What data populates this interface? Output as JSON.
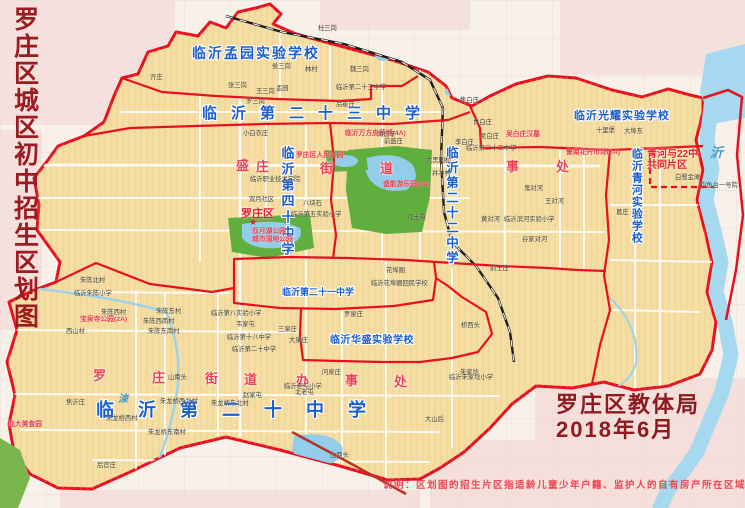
{
  "page": {
    "title_vertical": "罗庄区城区初中招生区划图"
  },
  "footer": {
    "agency": "罗庄区教体局",
    "date": "2018年6月",
    "disclaimer": "说明：区划图的招生片区指适龄儿童少年户籍、监护人的自有房产所在区域"
  },
  "colors": {
    "district_fill": "#f5dfa0",
    "boundary_red": "#e8101e",
    "school_blue": "#1a5ed0",
    "street_red": "#ee4253",
    "title_maroon": "#9c1b20",
    "river_blue": "#a6d9ef",
    "park_green": "#5fae3e"
  },
  "map": {
    "school_zone_labels": [
      {
        "t": "临沂孟园实验学校",
        "x": 192,
        "y": 46,
        "fs": 14,
        "ls": 2,
        "name": "label-mengyuan-school"
      },
      {
        "t": "临沂第二十三中学",
        "x": 202,
        "y": 106,
        "fs": 15,
        "ls": 14,
        "name": "label-no23-school"
      },
      {
        "t": "临沂第四十中学",
        "x": 279,
        "y": 146,
        "fs": 13,
        "ls": 3,
        "v": 1,
        "name": "label-no40-school"
      },
      {
        "t": "临沂第二十二中学",
        "x": 444,
        "y": 146,
        "fs": 12.5,
        "ls": 2.5,
        "v": 1,
        "name": "label-no22-school"
      },
      {
        "t": "临沂光耀实验学校",
        "x": 574,
        "y": 110,
        "fs": 11,
        "ls": 1,
        "name": "label-guangyao-school"
      },
      {
        "t": "临沂青河实验学校",
        "x": 630,
        "y": 148,
        "fs": 11,
        "ls": 1,
        "v": 1,
        "name": "label-qinghe-school"
      },
      {
        "t": "临沂第二十一中学",
        "x": 282,
        "y": 287,
        "fs": 9,
        "ls": 0,
        "name": "label-no21-school"
      },
      {
        "t": "临沂华盛实验学校",
        "x": 330,
        "y": 335,
        "fs": 10,
        "ls": 0.5,
        "name": "label-huasheng-school"
      },
      {
        "t": "临沂第二十中学",
        "x": 96,
        "y": 400,
        "fs": 18,
        "ls": 24,
        "name": "label-no20-school"
      }
    ],
    "street_chars": [
      {
        "t": "盛",
        "x": 236,
        "y": 159
      },
      {
        "t": "庄",
        "x": 256,
        "y": 160
      },
      {
        "t": "街",
        "x": 320,
        "y": 162
      },
      {
        "t": "道",
        "x": 380,
        "y": 162
      },
      {
        "t": "事",
        "x": 506,
        "y": 160
      },
      {
        "t": "处",
        "x": 556,
        "y": 160
      },
      {
        "t": "罗",
        "x": 93,
        "y": 369
      },
      {
        "t": "庄",
        "x": 152,
        "y": 371
      },
      {
        "t": "街",
        "x": 205,
        "y": 372
      },
      {
        "t": "道",
        "x": 244,
        "y": 373
      },
      {
        "t": "办",
        "x": 296,
        "y": 374
      },
      {
        "t": "事",
        "x": 345,
        "y": 374
      },
      {
        "t": "处",
        "x": 394,
        "y": 375
      }
    ],
    "district_seat": [
      {
        "t": "罗庄区",
        "x": 241,
        "y": 208,
        "name": "label-luozhuang-district-seat"
      }
    ],
    "red_zone_labels": [
      {
        "t": "青河与22中\n共同片区",
        "x": 647,
        "y": 149,
        "fs": 10,
        "name": "label-joint-zone-qinghe-no22"
      }
    ],
    "poi_labels": [
      {
        "t": "临沂万方皮革城(4A)",
        "x": 345,
        "y": 130,
        "name": "poi-wanfang-leather-city"
      },
      {
        "t": "吴白庄汉墓",
        "x": 506,
        "y": 131,
        "name": "poi-wubaizhuang-han-tomb"
      },
      {
        "t": "鲁南花卉市场(3A)",
        "x": 566,
        "y": 149,
        "name": "poi-lunan-flower-market"
      },
      {
        "t": "盛能游乐园(3A)",
        "x": 383,
        "y": 181,
        "name": "poi-shengneng-amusement-park"
      },
      {
        "t": "罗庄区人民公园",
        "x": 296,
        "y": 152,
        "name": "poi-renmin-park"
      },
      {
        "t": "双月湖公园\n城市湿地公园",
        "x": 252,
        "y": 228,
        "name": "poi-shuangyuehu-park"
      },
      {
        "t": "宝泉寺公园(2A)",
        "x": 80,
        "y": 316,
        "name": "poi-baoquansi-park"
      },
      {
        "t": "临大美食园",
        "x": 8,
        "y": 421,
        "name": "poi-linda-food-park"
      }
    ],
    "village_labels": [
      {
        "t": "杜三岗",
        "x": 318,
        "y": 25
      },
      {
        "t": "侯三岗",
        "x": 272,
        "y": 63
      },
      {
        "t": "林村",
        "x": 305,
        "y": 66
      },
      {
        "t": "魏三岗",
        "x": 350,
        "y": 66
      },
      {
        "t": "张三岗",
        "x": 228,
        "y": 82
      },
      {
        "t": "王三岗",
        "x": 256,
        "y": 88
      },
      {
        "t": "孟园",
        "x": 276,
        "y": 85
      },
      {
        "t": "罗三岗",
        "x": 246,
        "y": 98
      },
      {
        "t": "齐庄",
        "x": 150,
        "y": 74
      },
      {
        "t": "后崔庄",
        "x": 336,
        "y": 101
      },
      {
        "t": "临沂第二十三中学",
        "x": 336,
        "y": 84
      },
      {
        "t": "小白衣庄",
        "x": 243,
        "y": 130
      },
      {
        "t": "南官子",
        "x": 377,
        "y": 131
      },
      {
        "t": "前盛庄",
        "x": 384,
        "y": 138
      },
      {
        "t": "焦白庄",
        "x": 460,
        "y": 97
      },
      {
        "t": "青白庄",
        "x": 473,
        "y": 119
      },
      {
        "t": "李白庄",
        "x": 455,
        "y": 139
      },
      {
        "t": "吴白庄",
        "x": 480,
        "y": 133
      },
      {
        "t": "十里堡",
        "x": 596,
        "y": 127
      },
      {
        "t": "大埠东",
        "x": 624,
        "y": 128
      },
      {
        "t": "临沂第二十二中学",
        "x": 466,
        "y": 145
      },
      {
        "t": "大黑园村",
        "x": 426,
        "y": 157
      },
      {
        "t": "井冲村",
        "x": 432,
        "y": 170
      },
      {
        "t": "鬼对河",
        "x": 524,
        "y": 185
      },
      {
        "t": "王对河",
        "x": 545,
        "y": 198
      },
      {
        "t": "黄对河",
        "x": 481,
        "y": 216
      },
      {
        "t": "临沂滨河实验小学",
        "x": 504,
        "y": 216
      },
      {
        "t": "谷家对河",
        "x": 522,
        "y": 236
      },
      {
        "t": "前王庄",
        "x": 490,
        "y": 265
      },
      {
        "t": "红土屯",
        "x": 407,
        "y": 214
      },
      {
        "t": "双月社区",
        "x": 249,
        "y": 196
      },
      {
        "t": "八块石",
        "x": 303,
        "y": 200
      },
      {
        "t": "临沂第五实验小学",
        "x": 291,
        "y": 211
      },
      {
        "t": "临沂职业技术学院",
        "x": 250,
        "y": 176
      },
      {
        "t": "白鹭金滩",
        "x": 675,
        "y": 174
      },
      {
        "t": "钓鱼台一号院",
        "x": 700,
        "y": 182
      },
      {
        "t": "葛庄",
        "x": 616,
        "y": 209
      },
      {
        "t": "朱陈北村",
        "x": 80,
        "y": 277
      },
      {
        "t": "临沂朱陈小学",
        "x": 74,
        "y": 290
      },
      {
        "t": "朱陈西村",
        "x": 101,
        "y": 309
      },
      {
        "t": "朱陈东村",
        "x": 156,
        "y": 308
      },
      {
        "t": "朱陈西南村",
        "x": 143,
        "y": 318
      },
      {
        "t": "朱陈东南村",
        "x": 148,
        "y": 328
      },
      {
        "t": "西山村",
        "x": 66,
        "y": 328
      },
      {
        "t": "山南头",
        "x": 168,
        "y": 374
      },
      {
        "t": "临沂第八实验小学",
        "x": 211,
        "y": 310
      },
      {
        "t": "韦家屯",
        "x": 236,
        "y": 321
      },
      {
        "t": "赵家屯",
        "x": 243,
        "y": 392
      },
      {
        "t": "北老屯",
        "x": 295,
        "y": 389
      },
      {
        "t": "临沂老屯小学",
        "x": 284,
        "y": 383
      },
      {
        "t": "朱龙桥西北村",
        "x": 160,
        "y": 398
      },
      {
        "t": "朱龙桥东北村",
        "x": 211,
        "y": 400
      },
      {
        "t": "朱龙桥西村",
        "x": 106,
        "y": 415
      },
      {
        "t": "朱龙桥东南村",
        "x": 148,
        "y": 429
      },
      {
        "t": "后官庄",
        "x": 97,
        "y": 462
      },
      {
        "t": "山西头",
        "x": 330,
        "y": 452
      },
      {
        "t": "大山后",
        "x": 425,
        "y": 416
      },
      {
        "t": "焦沂庄",
        "x": 66,
        "y": 399
      },
      {
        "t": "花埠圈",
        "x": 386,
        "y": 267
      },
      {
        "t": "临沂花埠圈回民学校",
        "x": 371,
        "y": 280
      },
      {
        "t": "桥西头",
        "x": 461,
        "y": 322
      },
      {
        "t": "朱家埝",
        "x": 460,
        "y": 369
      },
      {
        "t": "临沂朱家埝小学",
        "x": 449,
        "y": 374
      },
      {
        "t": "罗泉庄",
        "x": 344,
        "y": 311
      },
      {
        "t": "三泉庄",
        "x": 278,
        "y": 326
      },
      {
        "t": "大泉庄",
        "x": 289,
        "y": 337
      },
      {
        "t": "问泉庄",
        "x": 322,
        "y": 369
      },
      {
        "t": "临沂第十八中学",
        "x": 227,
        "y": 334
      },
      {
        "t": "临沂第二十中学",
        "x": 232,
        "y": 346
      }
    ],
    "river_labels": [
      {
        "t": "沂",
        "x": 710,
        "y": 146,
        "fs": 13,
        "name": "label-yi-river"
      },
      {
        "t": "涑",
        "x": 118,
        "y": 394,
        "fs": 10,
        "name": "label-su-river"
      }
    ],
    "markers": [
      {
        "t": "★",
        "x": 249,
        "y": 217,
        "fs": 9,
        "name": "district-gov-star-marker"
      }
    ]
  }
}
